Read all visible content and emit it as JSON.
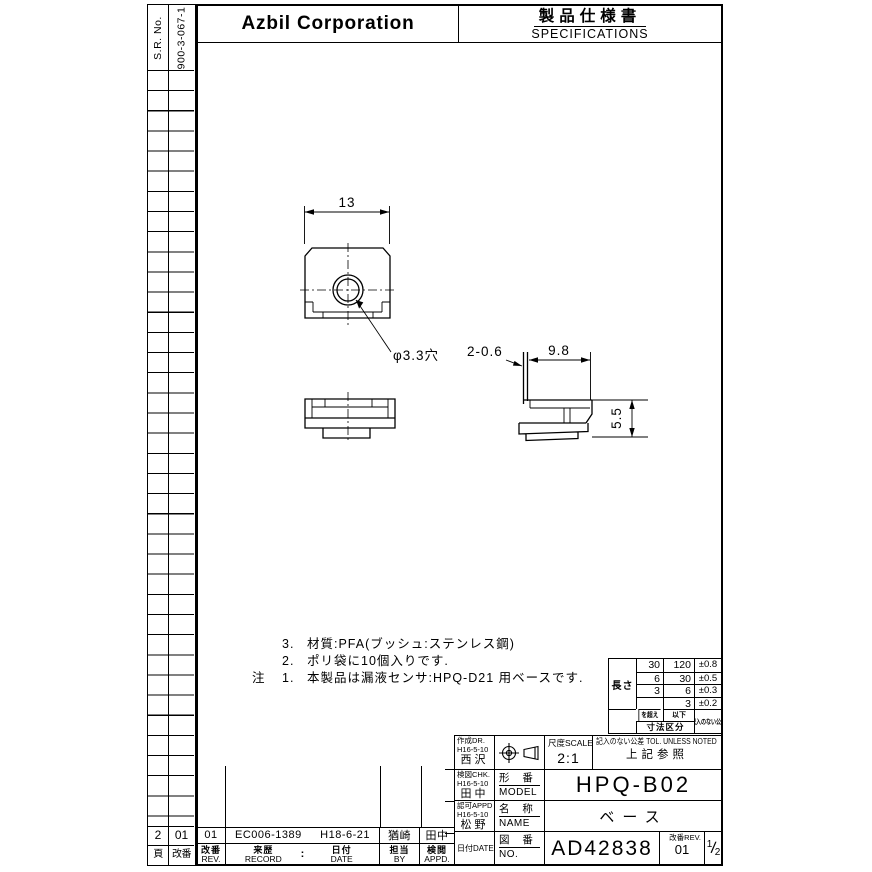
{
  "side_strip": {
    "sr_label": "S.R. No.",
    "sr_value": "900-3-067-1",
    "page_value": "2",
    "rev_value": "01",
    "page_label": "頁",
    "rev_label": "改番"
  },
  "header": {
    "company": "Azbil Corporation",
    "doc_title_jp": "製品仕様書",
    "doc_title_en": "SPECIFICATIONS"
  },
  "dimensions": {
    "width": "13",
    "hole": "φ3.3穴",
    "lip": "2-0.6",
    "depth": "9.8",
    "height": "5.5"
  },
  "notes": {
    "mark": "注",
    "line3_no": "3.",
    "line3": "材質:PFA(ブッシュ:ステンレス鋼)",
    "line2_no": "2.",
    "line2": "ポリ袋に10個入りです.",
    "line1_no": "1.",
    "line1": "本製品は漏液センサ:HPQ-D21 用ベースです."
  },
  "tolerance": {
    "length_label": "長さ",
    "r1_over": "30",
    "r1_under": "120",
    "r1_tol": "±0.8",
    "r2_over": "6",
    "r2_under": "30",
    "r2_tol": "±0.5",
    "r3_over": "3",
    "r3_under": "6",
    "r3_tol": "±0.3",
    "r4_over": "",
    "r4_under": "3",
    "r4_tol": "±0.2",
    "over_label": "を超え",
    "under_label": "以下",
    "range_label": "寸法区分",
    "unnoted_label": "記入のない公差"
  },
  "title_block": {
    "drawn_label": "作成DR.",
    "drawn_date": "H16-5-10",
    "drawn_name": "西沢",
    "checked_label": "検図CHK.",
    "checked_date": "H16-5-10",
    "checked_name": "田中",
    "approved_label": "認可APPD",
    "approved_date": "H16-5-10",
    "approved_name": "松野",
    "date_label": "日付DATE",
    "scale_label": "尺度SCALE",
    "scale_value": "2:1",
    "tol_label": "記入のない公差 TOL. UNLESS NOTED",
    "tol_value": "上記参照",
    "model_label_jp": "形 番",
    "model_label_en": "MODEL",
    "model_value": "HPQ-B02",
    "name_label_jp": "名 称",
    "name_label_en": "NAME",
    "name_value": "ベース",
    "no_label_jp": "図 番",
    "no_label_en": "NO.",
    "no_value": "AD42838",
    "rev_label": "改番REV.",
    "rev_value": "01",
    "sheet_num": "1",
    "sheet_den": "2"
  },
  "revision_table": {
    "rev": "01",
    "record": "EC006-1389",
    "date": "H18-6-21",
    "by": "猶崎",
    "appd": "田中",
    "rev_label_jp": "改番",
    "rev_label_en": "REV.",
    "record_label_jp": "来歴",
    "record_label_en": "RECORD",
    "colon": ":",
    "date_label_jp": "日付",
    "date_label_en": "DATE",
    "by_label_jp": "担当",
    "by_label_en": "BY",
    "appd_label_jp": "検閲",
    "appd_label_en": "APPD."
  }
}
